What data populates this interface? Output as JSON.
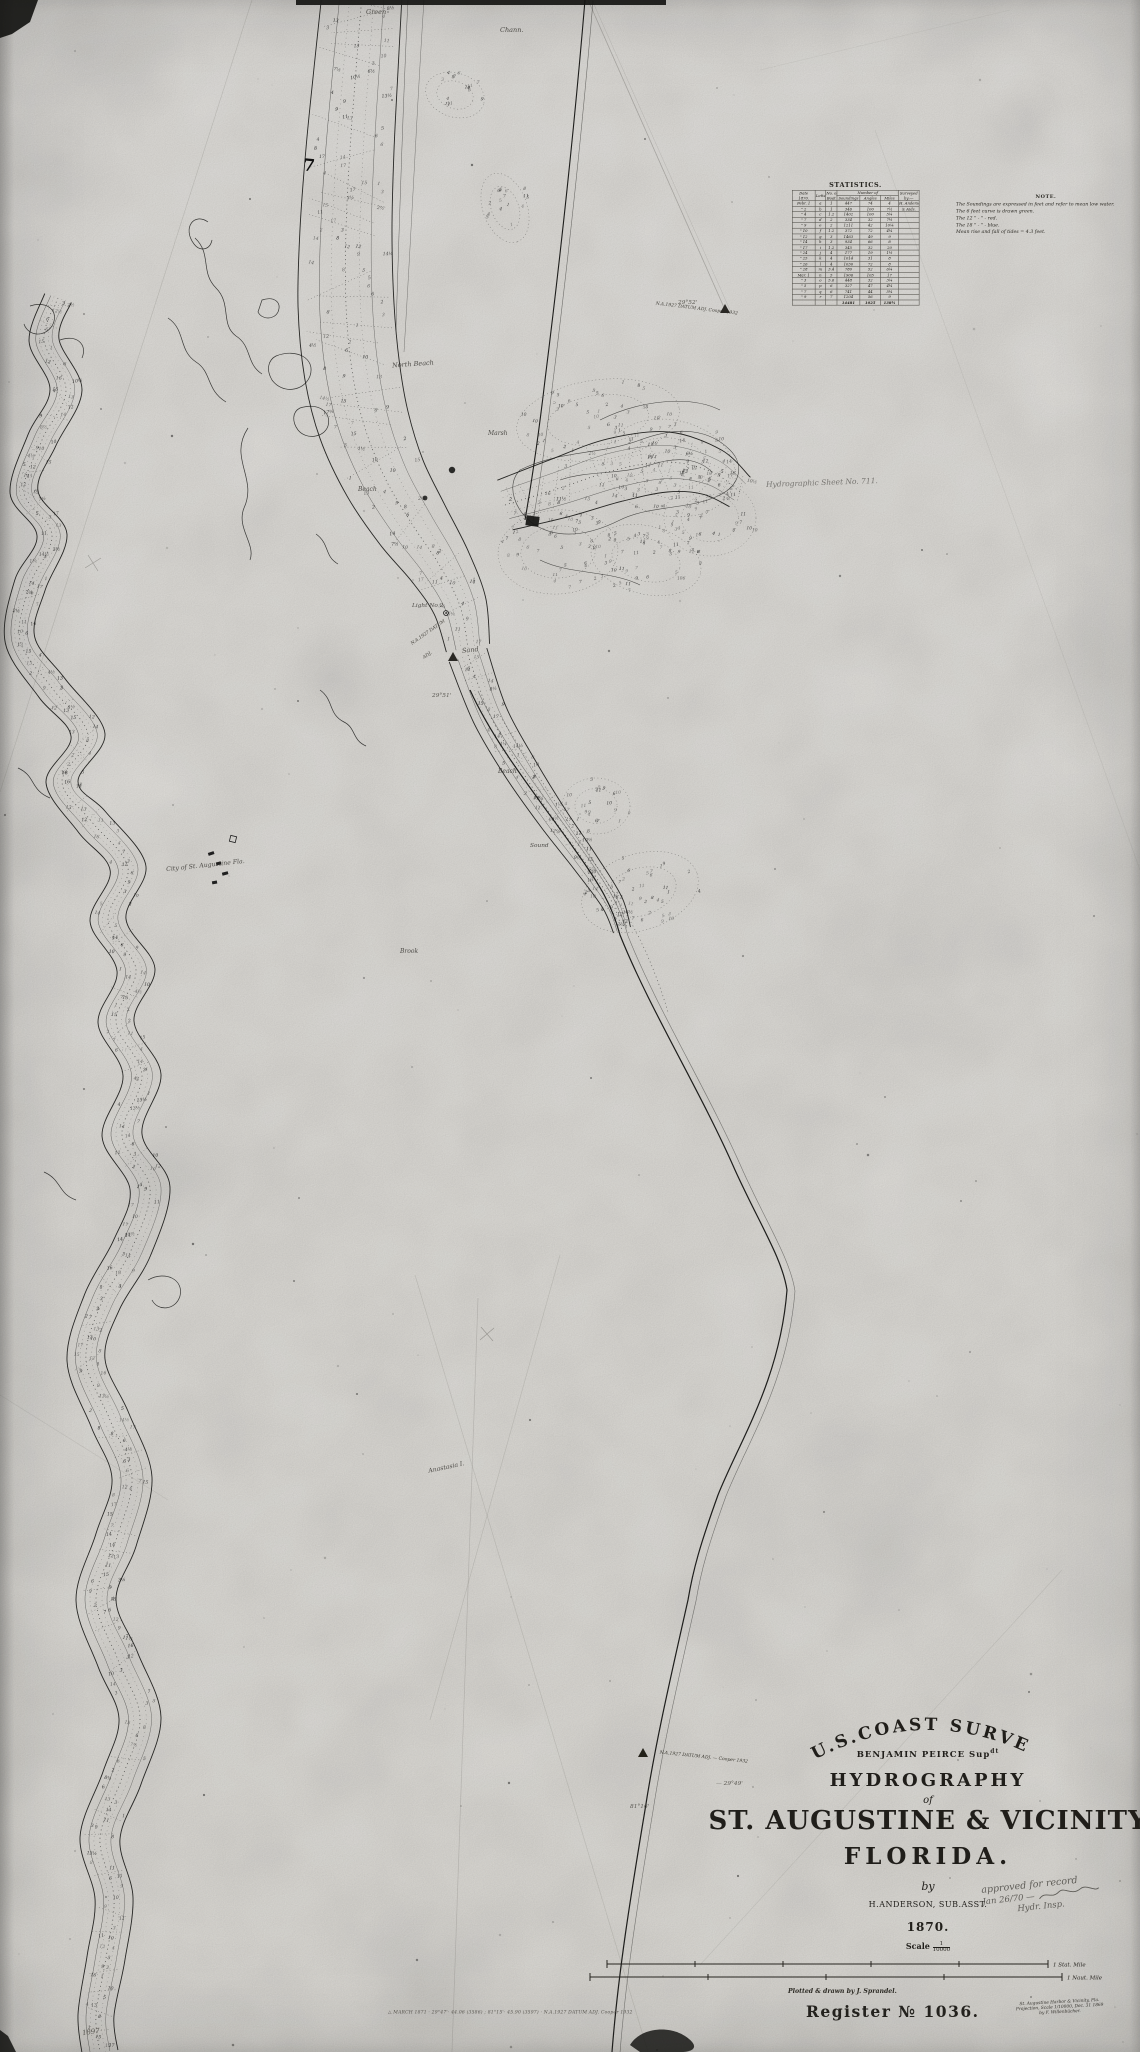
{
  "colors": {
    "ink": "#20201e",
    "paper": "#eceae6",
    "pencil": "#56544e"
  },
  "statistics": {
    "title": "STATISTICS.",
    "headers": {
      "date": "Date",
      "date_sub": "1870.",
      "letter": "Letter",
      "boat": "No. of",
      "boat_sub": "Boat",
      "number_of": "Number of",
      "soundings": "Soundings",
      "angles": "Angles",
      "miles": "Miles",
      "surveyed": "Surveyed",
      "surveyed_sub": "by:—"
    },
    "rows": [
      [
        "Febr. 1",
        "a",
        "1",
        "447",
        "74",
        "4",
        "H. Anderson"
      ],
      [
        "\" 2",
        "b",
        "1",
        "346",
        "100",
        "7½",
        "& Aids."
      ],
      [
        "\" 4",
        "c",
        "1.2",
        "1402",
        "100",
        "5¼",
        ""
      ],
      [
        "\" 7",
        "d",
        "2",
        "334",
        "32",
        "7½",
        ""
      ],
      [
        "\" 9",
        "e",
        "2",
        "1211",
        "42",
        "10¼",
        ""
      ],
      [
        "\" 10",
        "f",
        "1.2",
        "372",
        "72",
        "4¼",
        ""
      ],
      [
        "\" 12",
        "g",
        "3",
        "1463",
        "49",
        "9",
        ""
      ],
      [
        "\" 14",
        "h",
        "3",
        "934",
        "66",
        "8",
        ""
      ],
      [
        "\" 17",
        "i",
        "1.2",
        "345",
        "32",
        "20",
        ""
      ],
      [
        "\" 24",
        "j",
        "4",
        "177",
        "19",
        "1½",
        ""
      ],
      [
        "\" 25",
        "k",
        "4",
        "1014",
        "31",
        "8",
        ""
      ],
      [
        "\" 26",
        "l",
        "4",
        "1030",
        "72",
        "8",
        ""
      ],
      [
        "\" 28",
        "m",
        "3.4",
        "780",
        "52",
        "6¼",
        ""
      ],
      [
        "Mar. 1",
        "n",
        "5",
        "1906",
        "105",
        "17",
        ""
      ],
      [
        "\" 3",
        "o",
        "5.6",
        "448",
        "32",
        "3¼",
        ""
      ],
      [
        "\" 5",
        "p",
        "6",
        "327",
        "47",
        "4¼",
        ""
      ],
      [
        "\" 7",
        "q",
        "6",
        "741",
        "44",
        "5¼",
        ""
      ],
      [
        "\" 9",
        "r",
        "7",
        "1204",
        "56",
        "9",
        ""
      ]
    ],
    "total": [
      "",
      "",
      "",
      "14481",
      "1025",
      "138¼",
      ""
    ]
  },
  "note": {
    "title": "NOTE.",
    "lines": [
      "The Soundings are expressed in feet and refer to mean low water.",
      "The 6 feet curve is drawn green.",
      "The 12   \"      -      \"      -      red.",
      "The 18   \"      -      \"      -      blue.",
      "Mean rise and fall of tides = 4.3 feet."
    ]
  },
  "title_block": {
    "survey": "U.S.COAST SURVEY",
    "peirce_a": "BENJAMIN PEIRCE Sup",
    "peirce_b": "dt",
    "hydrography": "HYDROGRAPHY",
    "of": "of",
    "staugustine": "ST. AUGUSTINE & VICINITY",
    "florida": "FLORIDA.",
    "by": "by",
    "surveyor": "H.ANDERSON, SUB.ASST.",
    "year": "1870.",
    "scale_word": "Scale",
    "scale_num": "1",
    "scale_den": "10000"
  },
  "scale_bars": {
    "statute": "1 Stat. Mile",
    "nautical": "1 Naut. Mile"
  },
  "credits": {
    "plotted": "Plotted & drawn by J. Sprandel.",
    "register": "Register № 1036.",
    "projection": [
      "St. Augustine Harbor & Vicinity, Fla.",
      "Projection, Scale 1/10000, Dec. 31 1869",
      "by F. Willenbücher."
    ]
  },
  "approval": {
    "line1": "approved for record",
    "line2": "Jan 26/70 —",
    "line3": "Hydr. Insp."
  },
  "datums": {
    "top": {
      "lat": "29°52'",
      "label": "N.A.1927 DATUM ADJ. Cooper 1932"
    },
    "mid": {
      "line1": "N.A.1927 DATUM",
      "line2": "ADJ.",
      "lat": "29°51'"
    },
    "title_area": {
      "label": "N.A.1927 DATUM ADJ. — Cooper 1932",
      "lat": "— 29°49'",
      "lon": "81°16'"
    },
    "pencil_bottom": "△ MARCH 1871 · 29°47'· 44.06 (3586) ;  81°15'· 45.90 (3597) · N.A.1927 DATUM ADJ. Cooper 1932",
    "pencil_year": "1897"
  },
  "map": {
    "ink_mark": "7",
    "labels": [
      {
        "text": "Green",
        "x": 366,
        "y": 8,
        "s": 6.5,
        "r": 0
      },
      {
        "text": "Chann.",
        "x": 500,
        "y": 26,
        "s": 6.5,
        "r": 0
      },
      {
        "text": "North Beach",
        "x": 392,
        "y": 360,
        "s": 6.5,
        "r": -4
      },
      {
        "text": "Marsh",
        "x": 488,
        "y": 430,
        "s": 6,
        "r": 0
      },
      {
        "text": "Beach",
        "x": 358,
        "y": 486,
        "s": 6,
        "r": 0
      },
      {
        "text": "Light No 2",
        "x": 412,
        "y": 603,
        "s": 5.8,
        "r": 0
      },
      {
        "text": "Sand",
        "x": 462,
        "y": 646,
        "s": 6.5,
        "r": -6
      },
      {
        "text": "Hydrographic Sheet No. 711.",
        "x": 766,
        "y": 478,
        "s": 7.5,
        "r": -2,
        "cls": "faint"
      },
      {
        "text": "Beach",
        "x": 498,
        "y": 768,
        "s": 6,
        "r": 0
      },
      {
        "text": "Sound",
        "x": 530,
        "y": 843,
        "s": 5.8,
        "r": 0
      },
      {
        "text": "City of St. Augustine Fla.",
        "x": 166,
        "y": 862,
        "s": 6.2,
        "r": -6
      },
      {
        "text": "Brook",
        "x": 400,
        "y": 948,
        "s": 6,
        "r": 0
      },
      {
        "text": "Anastasia I.",
        "x": 428,
        "y": 1464,
        "s": 6.2,
        "r": -12
      }
    ]
  }
}
